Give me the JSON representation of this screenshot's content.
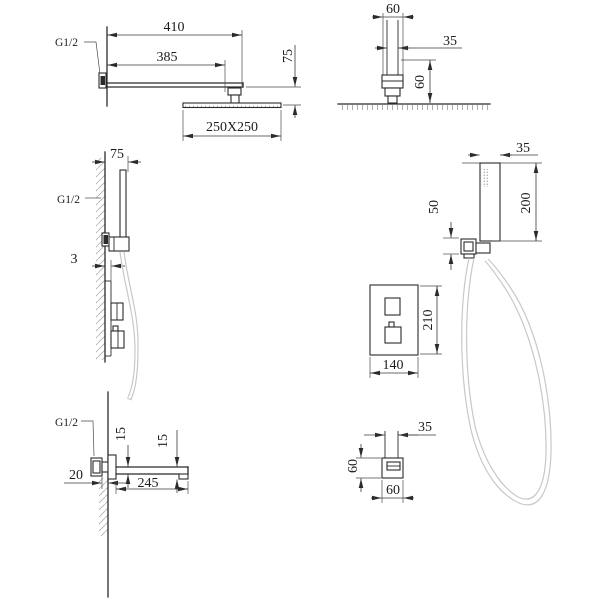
{
  "drawing": {
    "type": "technical-installation-drawing",
    "subject": "concealed shower system dimensions",
    "units_shown": "mm"
  },
  "views": {
    "overhead_shower_front": {
      "overall_width": "410",
      "arm_length": "385",
      "head_drop": "75",
      "head_size": "250X250",
      "thread": "G1/2"
    },
    "overhead_shower_side": {
      "bracket_width": "60",
      "pipe_width": "35",
      "bracket_height": "60"
    },
    "hand_shower_side": {
      "wall_offset": "75",
      "thread": "G1/2",
      "plate_offset": "3"
    },
    "hand_shower_front": {
      "head_width": "35",
      "body_length": "200",
      "holder_height": "50"
    },
    "mixer_front": {
      "plate_height": "210",
      "plate_width": "140"
    },
    "spout_side": {
      "thread": "G1/2",
      "inlet_depth": "20",
      "bar_height_rear": "15",
      "bar_height_front": "15",
      "spout_length": "245"
    },
    "spout_front": {
      "pipe_width": "35",
      "body_height": "60",
      "body_width": "60"
    }
  },
  "colors": {
    "line": "#2b2b2b",
    "dimension": "#3a3a3a",
    "hose": "#c8c8c8",
    "hatch": "#b0b0b0",
    "background": "#ffffff"
  }
}
